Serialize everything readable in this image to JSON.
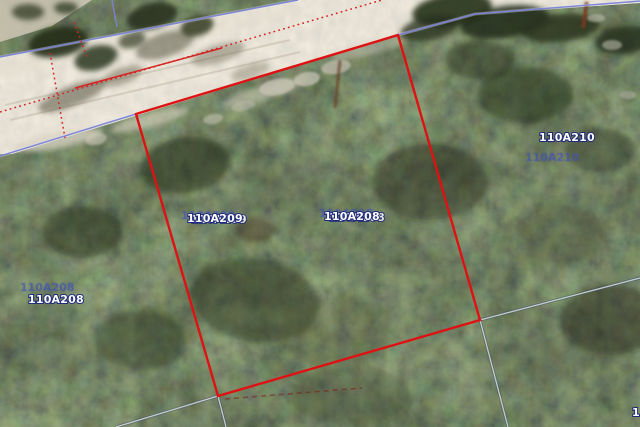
{
  "app": {
    "name": "aerial-parcel-map-view"
  },
  "map": {
    "description": "Satellite aerial view of wooded lots along a dirt road with cadastral parcel overlay; subject lot outlined in red",
    "highlight_parcel": {
      "points_str": "136,114 398,35 480,320 218,396",
      "corners": [
        [
          136,
          114
        ],
        [
          398,
          35
        ],
        [
          480,
          320
        ],
        [
          218,
          396
        ]
      ],
      "stroke_color": "#de1212"
    },
    "labels": [
      {
        "id": "center-left",
        "text": "110A209",
        "ghost_text": "110A209"
      },
      {
        "id": "center-right",
        "text": "110A208",
        "ghost_text": "110A208"
      },
      {
        "id": "right",
        "text": "110A210",
        "ghost_text": "110A210"
      },
      {
        "id": "left",
        "text": "110A208",
        "ghost_text": "110A208"
      },
      {
        "id": "partial-bottom-right",
        "text": "1"
      }
    ],
    "colors": {
      "highlight_red": "#de1212",
      "cadastral_blue": "#7b82d6",
      "cadastral_gray": "#c3ccd2",
      "survey_dotted_red": "#d42525",
      "label_fill": "#ffffff",
      "label_halo": "#1e2a78",
      "ghost_label": "#4053b0",
      "road_tan": "#d1c8b2",
      "vegetation_dark": "#39432a"
    }
  }
}
